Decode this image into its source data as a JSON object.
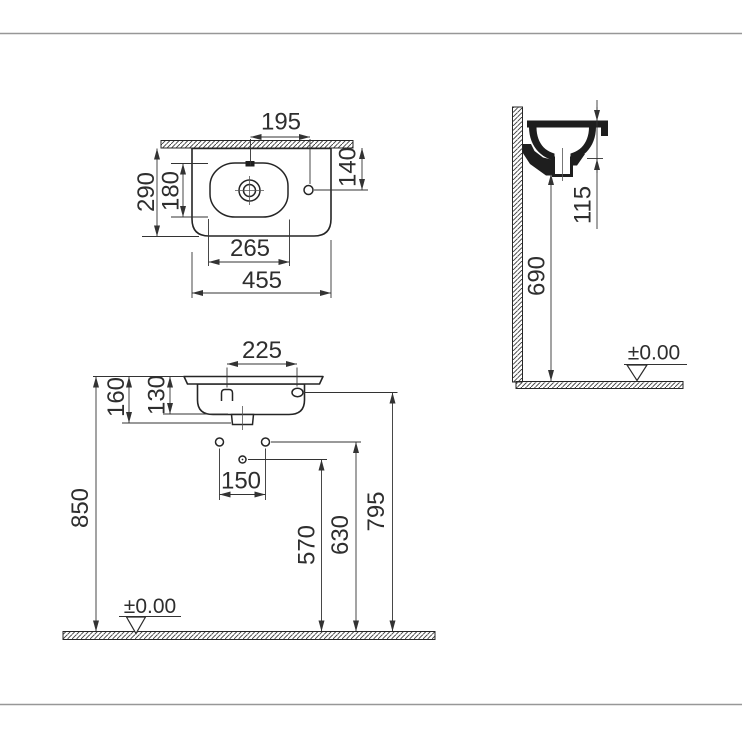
{
  "drawing": {
    "plan_view": {
      "dims": {
        "d195": "195",
        "d140": "140",
        "d290": "290",
        "d180": "180",
        "d265": "265",
        "d455": "455"
      }
    },
    "side_view": {
      "dims": {
        "d115": "115",
        "d690": "690"
      },
      "datum": "±0.00"
    },
    "front_view": {
      "dims": {
        "d225": "225",
        "d160": "160",
        "d130": "130",
        "d150": "150",
        "d850": "850",
        "d570": "570",
        "d630": "630",
        "d795": "795"
      },
      "datum": "±0.00"
    },
    "colors": {
      "line": "#252525",
      "dim_line": "#333333",
      "frame_line": "#979797",
      "background": "#ffffff"
    }
  }
}
